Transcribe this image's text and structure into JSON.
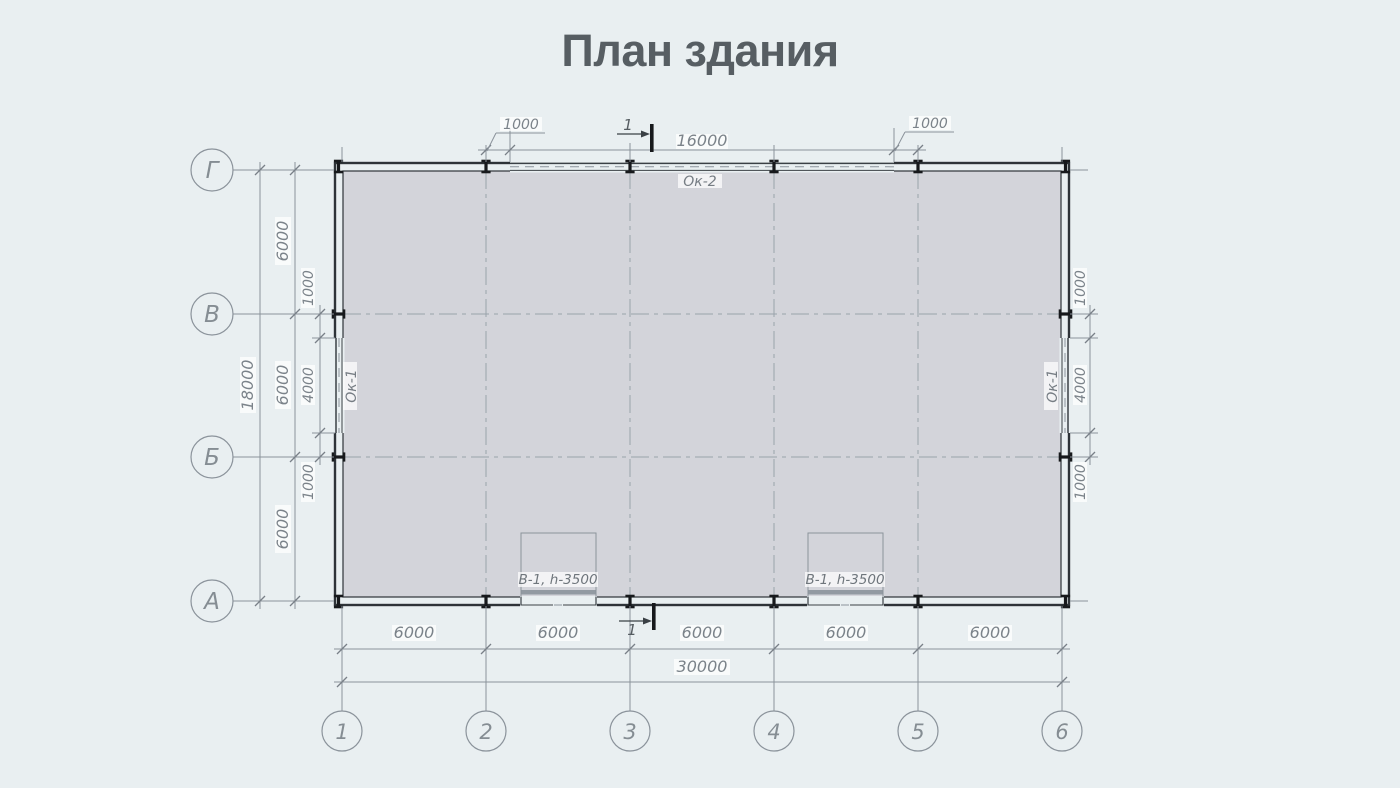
{
  "title": "План здания",
  "axes": {
    "columns": [
      "1",
      "2",
      "3",
      "4",
      "5",
      "6"
    ],
    "rows": [
      "Г",
      "В",
      "Б",
      "А"
    ]
  },
  "dims": {
    "top_offset_left": "1000",
    "top_window": "16000",
    "top_offset_right": "1000",
    "left_total": "18000",
    "left_bays": [
      "6000",
      "6000",
      "6000"
    ],
    "left_window": [
      "1000",
      "4000",
      "1000"
    ],
    "right_window": [
      "1000",
      "4000",
      "1000"
    ],
    "bottom_bays": [
      "6000",
      "6000",
      "6000",
      "6000",
      "6000"
    ],
    "bottom_total": "30000"
  },
  "marks": {
    "window_top": "Ок-2",
    "window_left": "Ок-1",
    "window_right": "Ок-1",
    "gate_left": "В-1, h-3500",
    "gate_right": "В-1, h-3500",
    "section_top": "1",
    "section_bottom": "1"
  },
  "colors": {
    "background": "#e9eff1",
    "floor": "#d3d4da",
    "walls": "#2e3338",
    "lines": "#8b939b",
    "text": "#7b838a",
    "title": "#575e63"
  }
}
